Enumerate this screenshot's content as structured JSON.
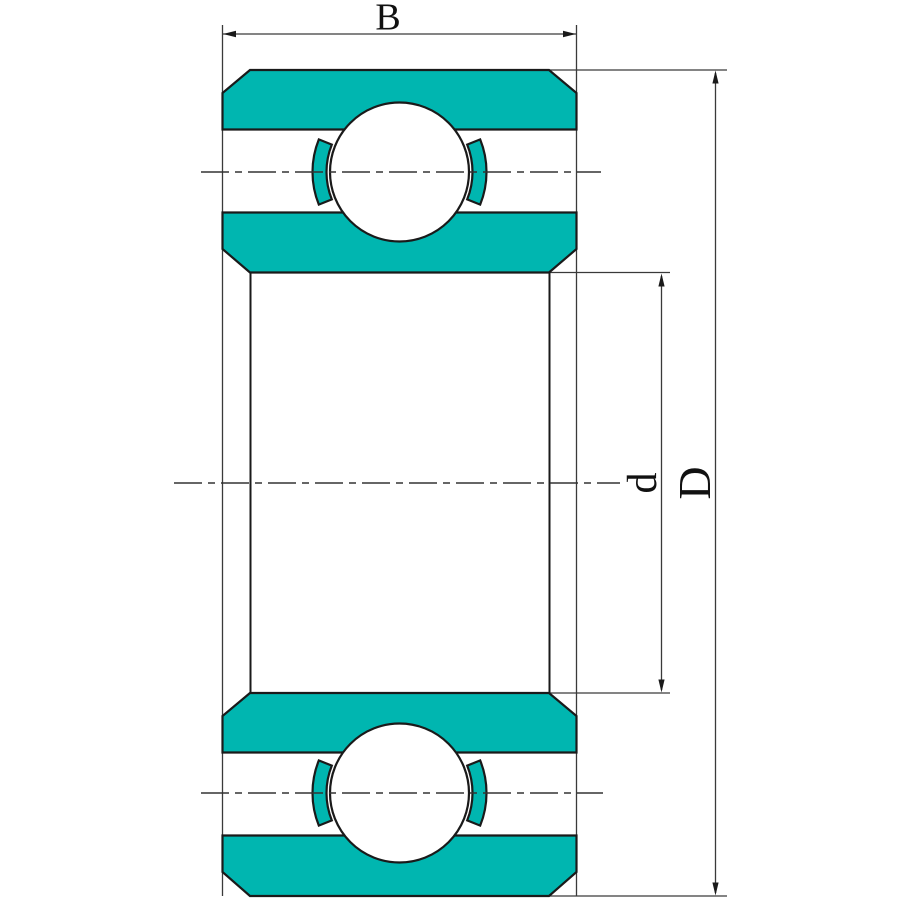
{
  "drawing": {
    "title": "Deep groove ball bearing axial cross-section",
    "labels": {
      "width": "B",
      "bore_diameter": "d",
      "outer_diameter": "D"
    },
    "colors": {
      "ring_fill": "#00b6b0",
      "outline": "#1a1a1a",
      "thin_line": "#3a3a3a",
      "background": "#ffffff"
    }
  }
}
